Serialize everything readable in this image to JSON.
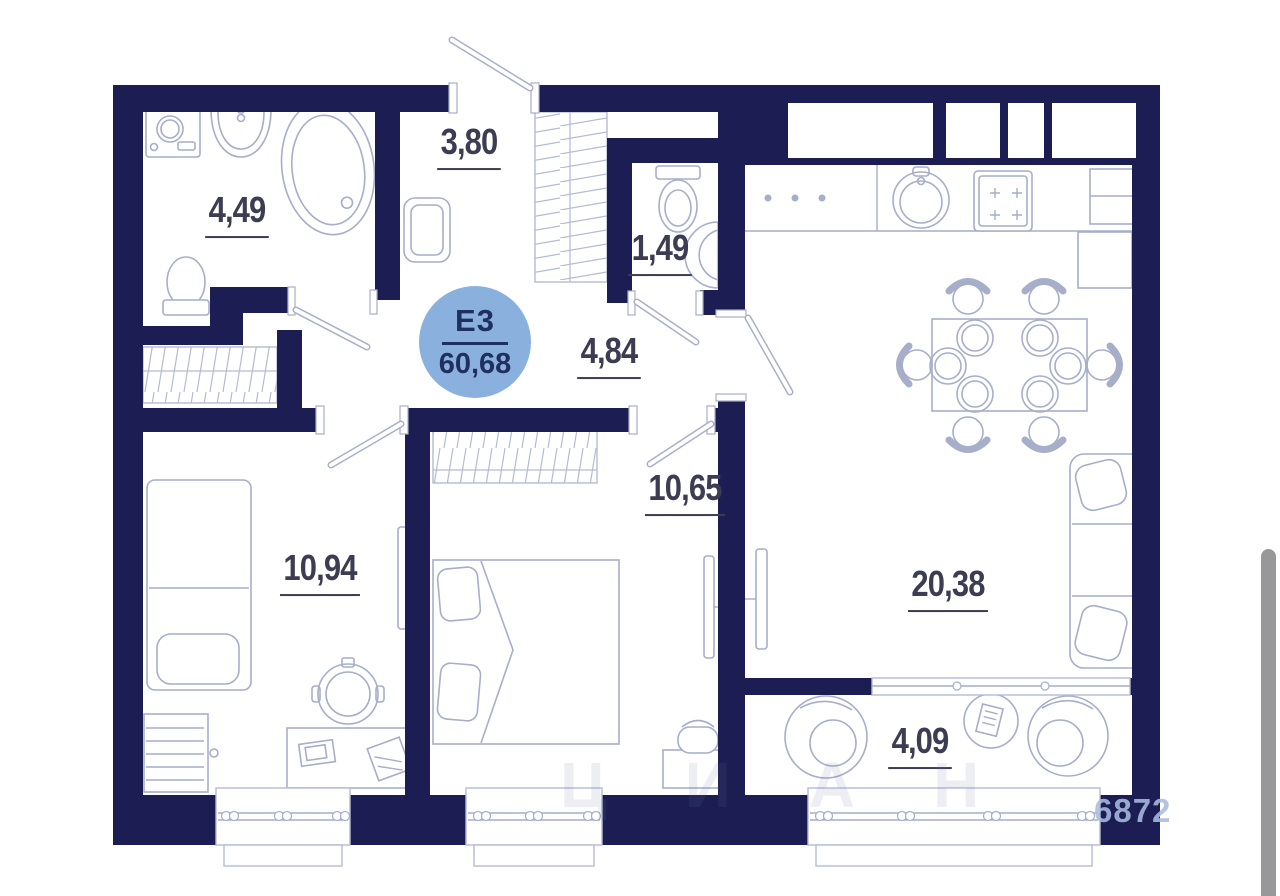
{
  "plan": {
    "badge": {
      "unit": "E3",
      "total_area": "60,68"
    },
    "rooms": [
      {
        "id": "bathroom",
        "area": "4,49"
      },
      {
        "id": "hallway",
        "area": "3,80"
      },
      {
        "id": "wc",
        "area": "1,49"
      },
      {
        "id": "corridor",
        "area": "4,84"
      },
      {
        "id": "bedroom-1",
        "area": "10,94"
      },
      {
        "id": "bedroom-2",
        "area": "10,65"
      },
      {
        "id": "living-kitchen",
        "area": "20,38"
      },
      {
        "id": "balcony",
        "area": "4,09"
      }
    ],
    "watermark": {
      "letters": "ЦИАН",
      "digits": "6872"
    },
    "colors": {
      "wall": "#1c1d52",
      "badge": "#8ab1de",
      "furn": "#a6aec9",
      "label": "#3c3c52",
      "badge-text": "#1f3060"
    }
  }
}
